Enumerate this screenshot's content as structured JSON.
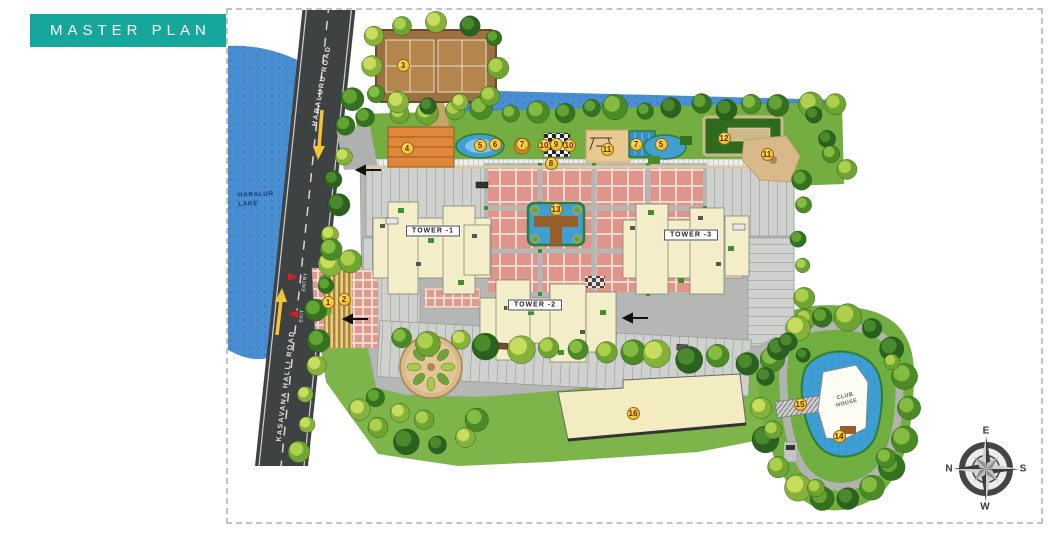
{
  "page": {
    "badge": "MASTER PLAN"
  },
  "plan": {
    "lake": {
      "line1": "HARALUR",
      "line2": "LAKE"
    },
    "roads": [
      {
        "name": "HARALURU ROAD"
      },
      {
        "name": "KASAVANA HALLI ROAD"
      }
    ],
    "gates": {
      "entry": "ENTRY",
      "exit": "EXIT"
    },
    "towers": [
      {
        "label": "TOWER -1"
      },
      {
        "label": "TOWER -2"
      },
      {
        "label": "TOWER -3"
      }
    ],
    "club_house": {
      "line1": "CLUB",
      "line2": "HOUSE"
    },
    "compass": {
      "north": "N",
      "east": "E",
      "south": "S",
      "west": "W"
    },
    "markers": [
      {
        "n": "1",
        "x": 100,
        "y": 292
      },
      {
        "n": "2",
        "x": 116,
        "y": 289
      },
      {
        "n": "3",
        "x": 175,
        "y": 55
      },
      {
        "n": "4",
        "x": 179,
        "y": 138
      },
      {
        "n": "5",
        "x": 252,
        "y": 135
      },
      {
        "n": "6",
        "x": 267,
        "y": 134
      },
      {
        "n": "7",
        "x": 294,
        "y": 134
      },
      {
        "n": "10",
        "x": 316,
        "y": 135
      },
      {
        "n": "9",
        "x": 328,
        "y": 134
      },
      {
        "n": "10",
        "x": 341,
        "y": 135
      },
      {
        "n": "11",
        "x": 379,
        "y": 139
      },
      {
        "n": "7",
        "x": 408,
        "y": 134
      },
      {
        "n": "5",
        "x": 433,
        "y": 134
      },
      {
        "n": "12",
        "x": 496,
        "y": 128
      },
      {
        "n": "8",
        "x": 323,
        "y": 153
      },
      {
        "n": "11",
        "x": 539,
        "y": 144
      },
      {
        "n": "13",
        "x": 328,
        "y": 199
      },
      {
        "n": "14",
        "x": 611,
        "y": 426
      },
      {
        "n": "15",
        "x": 572,
        "y": 394
      },
      {
        "n": "16",
        "x": 405,
        "y": 403
      }
    ]
  },
  "palette": {
    "badge_teal": "#16a79c",
    "lake_blue": "#4a8ed2",
    "road_gray": "#3f4243",
    "site_green": "#74ad40",
    "podium_gray": "#b4b7b4",
    "courtyard_salmon": "#e0958a",
    "tower_cream": "#f3edc9",
    "marker_yellow": "#ecbc29",
    "pool_blue": "#3f9fd0"
  }
}
